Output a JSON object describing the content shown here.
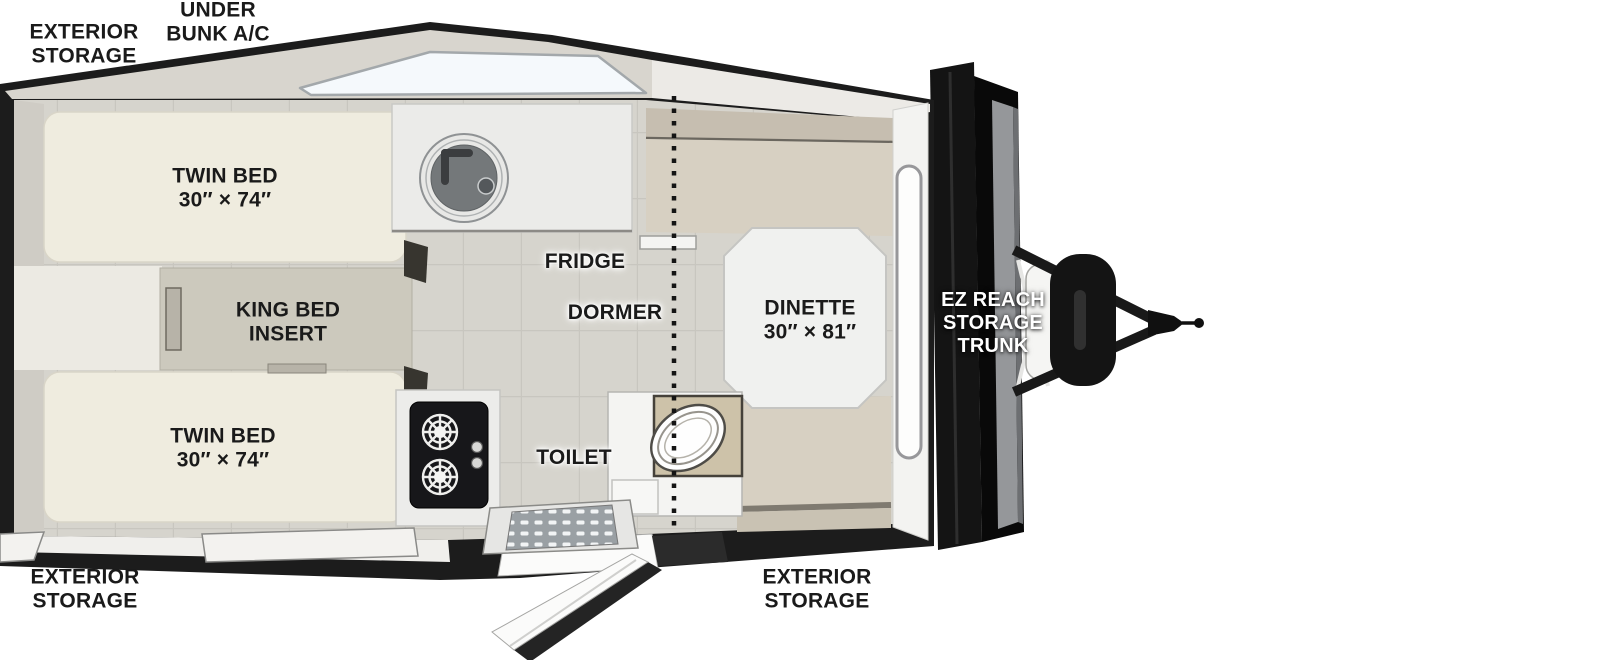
{
  "floorplan": {
    "title": "A-frame camper floor plan, top view",
    "labels": {
      "exterior_storage_top": "EXTERIOR\nSTORAGE",
      "under_bunk_ac": "UNDER\nBUNK A/C",
      "twin_bed_top": "TWIN BED\n30″ × 74″",
      "king_bed_insert": "KING BED\nINSERT",
      "twin_bed_bottom": "TWIN BED\n30″ × 74″",
      "fridge": "FRIDGE",
      "dormer": "DORMER",
      "dinette": "DINETTE\n30″ × 81″",
      "toilet": "TOILET",
      "ez_reach_storage_trunk": "EZ REACH\nSTORAGE\nTRUNK",
      "exterior_storage_bottom_left": "EXTERIOR\nSTORAGE",
      "exterior_storage_bottom_right": "EXTERIOR\nSTORAGE"
    },
    "colors": {
      "wall": "#1c1c1c",
      "roof": "#d8d5ce",
      "skylight": "#f5f9fc",
      "floor": "#d6d4cd",
      "mattress": "#efecdf",
      "insert": "#ccc9bd",
      "bench": "#d7d0c2",
      "bench_back": "#c6beb0",
      "bench_dark": "#b9ac96",
      "counter": "#ebebe9",
      "fixture_white": "#f4f4f2",
      "stove": "#17171a",
      "accent_black": "#141414",
      "label": "#1a1a1a",
      "label_light": "#ffffff"
    }
  }
}
